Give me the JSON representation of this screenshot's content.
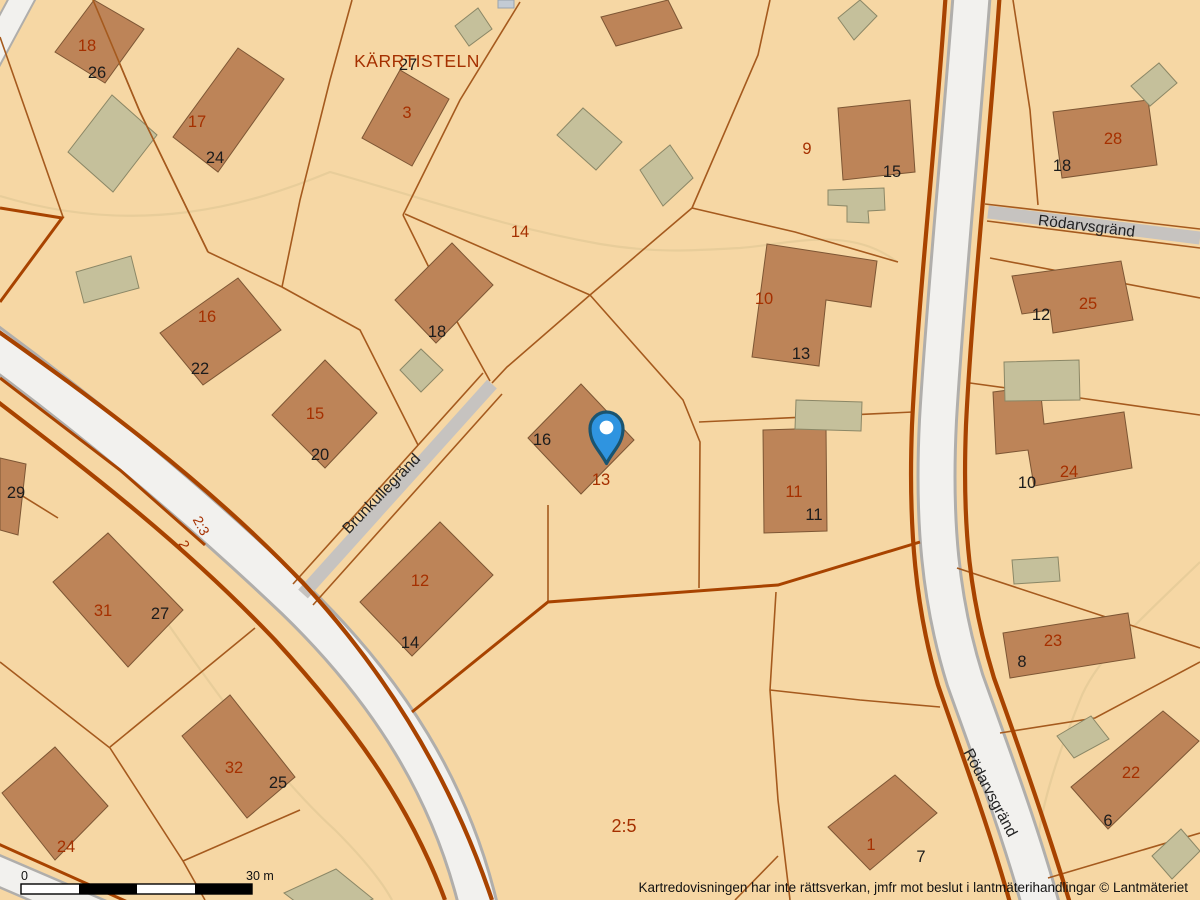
{
  "map": {
    "area_name": {
      "text": "KÄRRTISTELN",
      "x": 417,
      "y": 67
    },
    "streets": [
      {
        "text": "Brunkullegränd",
        "x": 385,
        "y": 497,
        "r": -46
      },
      {
        "text": "Rödarvsgränd",
        "x": 1086,
        "y": 231,
        "r": 7
      },
      {
        "text": "Rödarvsgränd",
        "x": 986,
        "y": 795,
        "r": 62
      }
    ],
    "parcel_labels": [
      {
        "text": "18",
        "x": 87,
        "y": 51
      },
      {
        "text": "17",
        "x": 197,
        "y": 127
      },
      {
        "text": "3",
        "x": 407,
        "y": 118
      },
      {
        "text": "9",
        "x": 807,
        "y": 154
      },
      {
        "text": "28",
        "x": 1113,
        "y": 144
      },
      {
        "text": "25",
        "x": 1088,
        "y": 309
      },
      {
        "text": "16",
        "x": 207,
        "y": 322
      },
      {
        "text": "15",
        "x": 315,
        "y": 419
      },
      {
        "text": "10",
        "x": 764,
        "y": 304
      },
      {
        "text": "14",
        "x": 520,
        "y": 237
      },
      {
        "text": "13",
        "x": 601,
        "y": 485
      },
      {
        "text": "11",
        "x": 794,
        "y": 497
      },
      {
        "text": "24",
        "x": 1069,
        "y": 477
      },
      {
        "text": "2:3",
        "x": 197,
        "y": 528,
        "r": 62,
        "small": true
      },
      {
        "text": "2",
        "x": 180,
        "y": 547,
        "r": 62,
        "small": true
      },
      {
        "text": "31",
        "x": 103,
        "y": 616
      },
      {
        "text": "12",
        "x": 420,
        "y": 586
      },
      {
        "text": "32",
        "x": 234,
        "y": 773
      },
      {
        "text": "24",
        "x": 66,
        "y": 852
      },
      {
        "text": "2:5",
        "x": 624,
        "y": 832,
        "big": true
      },
      {
        "text": "23",
        "x": 1053,
        "y": 646
      },
      {
        "text": "22",
        "x": 1131,
        "y": 778
      },
      {
        "text": "1",
        "x": 871,
        "y": 850
      }
    ],
    "address_labels": [
      {
        "text": "26",
        "x": 97,
        "y": 78
      },
      {
        "text": "24",
        "x": 215,
        "y": 163
      },
      {
        "text": "27",
        "x": 408,
        "y": 70
      },
      {
        "text": "22",
        "x": 200,
        "y": 374
      },
      {
        "text": "20",
        "x": 320,
        "y": 460
      },
      {
        "text": "29",
        "x": 16,
        "y": 498
      },
      {
        "text": "18",
        "x": 437,
        "y": 337
      },
      {
        "text": "16",
        "x": 542,
        "y": 445
      },
      {
        "text": "13",
        "x": 801,
        "y": 359
      },
      {
        "text": "15",
        "x": 892,
        "y": 177
      },
      {
        "text": "18",
        "x": 1062,
        "y": 171
      },
      {
        "text": "12",
        "x": 1041,
        "y": 320
      },
      {
        "text": "11",
        "x": 814,
        "y": 520
      },
      {
        "text": "10",
        "x": 1027,
        "y": 488
      },
      {
        "text": "27",
        "x": 160,
        "y": 619
      },
      {
        "text": "25",
        "x": 278,
        "y": 788
      },
      {
        "text": "14",
        "x": 410,
        "y": 648
      },
      {
        "text": "8",
        "x": 1022,
        "y": 667
      },
      {
        "text": "6",
        "x": 1108,
        "y": 826
      },
      {
        "text": "7",
        "x": 921,
        "y": 862
      }
    ],
    "scale_bar": {
      "start": "0",
      "end": "30 m"
    },
    "copyright": "Kartredovisningen har inte rättsverkan, jmfr mot beslut i lantmäterihandlingar © Lantmäteriet",
    "pin": {
      "label": "selected-location"
    },
    "colors": {
      "background": "#f6d7a4",
      "building": "#bd8458",
      "shed": "#c5c09b",
      "road": "#f2f1ee",
      "boundary": "#a84300",
      "parcel_line": "#a55a1e",
      "label_red": "#a53000",
      "label_black": "#1c1c1c",
      "pin_blue": "#2f94e0"
    }
  }
}
